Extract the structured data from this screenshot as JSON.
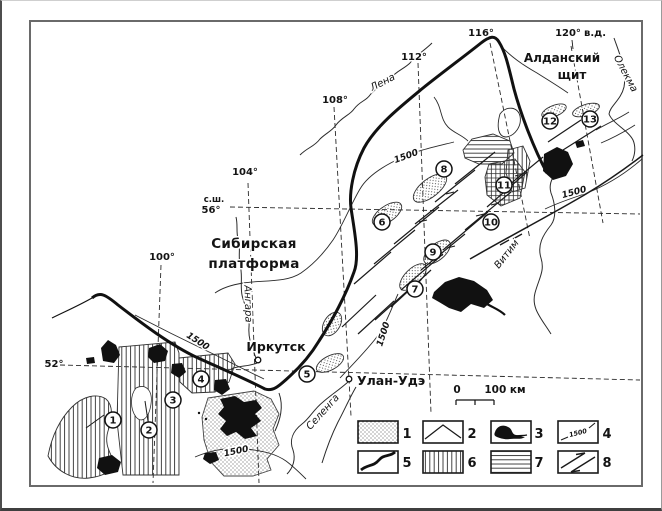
{
  "map": {
    "region_labels": {
      "platform_l1": "Сибирская",
      "platform_l2": "платформа",
      "shield_l1": "Алданский",
      "shield_l2": "щит"
    },
    "graticule": {
      "lat_prefix": "с.ш.",
      "lat56": "56°",
      "lat52": "52°",
      "lon100": "100°",
      "lon104": "104°",
      "lon108": "108°",
      "lon112": "112°",
      "lon116": "116°",
      "lon120": "120°",
      "lon_suffix": "в.д."
    },
    "rivers": {
      "lena": "Лена",
      "angara": "Ангара",
      "selenga": "Селенга",
      "vitim": "Витим",
      "olekma": "Олекма"
    },
    "cities": {
      "irkutsk": "Иркутск",
      "ulanude": "Улан-Удэ"
    },
    "contour_label": "1500",
    "site_numbers": [
      "1",
      "2",
      "3",
      "4",
      "5",
      "6",
      "7",
      "8",
      "9",
      "10",
      "11",
      "12",
      "13"
    ],
    "scalebar": {
      "zero": "0",
      "hundred": "100 км"
    },
    "legend_numbers": [
      "1",
      "2",
      "3",
      "4",
      "5",
      "6",
      "7",
      "8"
    ],
    "colors": {
      "ink": "#1a1a1a",
      "frame_gray": "#5a5a5a"
    }
  }
}
